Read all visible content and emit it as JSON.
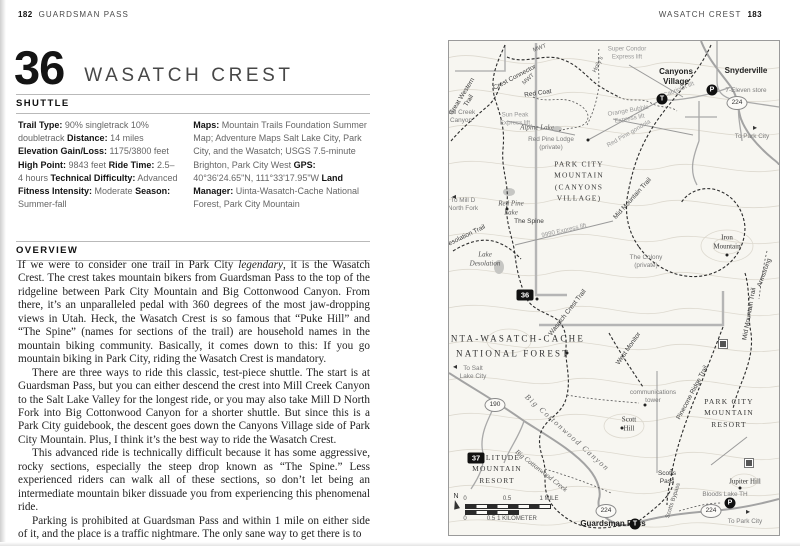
{
  "left_page": {
    "page_number": "182",
    "running_header": "GUARDSMAN PASS",
    "ride_number": "36",
    "ride_name": "WASATCH CREST",
    "shuttle_header": "SHUTTLE",
    "overview_header": "OVERVIEW",
    "stats_left": [
      {
        "label": "Trail Type:",
        "value": "90% singletrack 10% doubletrack"
      },
      {
        "label": "Distance:",
        "value": "14 miles"
      },
      {
        "label": "Elevation Gain/Loss:",
        "value": "1175/3800 feet"
      },
      {
        "label": "High Point:",
        "value": "9843 feet"
      },
      {
        "label": "Ride Time:",
        "value": "2.5–4 hours"
      },
      {
        "label": "Technical Difficulty:",
        "value": "Advanced"
      },
      {
        "label": "Fitness Intensity:",
        "value": "Moderate"
      },
      {
        "label": "Season:",
        "value": "Summer-fall"
      }
    ],
    "stats_right": [
      {
        "label": "Maps:",
        "value": "Mountain Trails Foundation Summer Map; Adventure Maps Salt Lake City, Park City, and the Wasatch; USGS 7.5-minute Brighton, Park City West"
      },
      {
        "label": "GPS:",
        "value": "40°36'24.65\"N, 111°33'17.95\"W"
      },
      {
        "label": "Land Manager:",
        "value": "Uinta-Wasatch-Cache National Forest, Park City Mountain"
      }
    ],
    "overview_paragraphs": [
      "If we were to consider one trail in Park City *legendary*, it is the Wasatch Crest. The crest takes mountain bikers from Guardsman Pass to the top of the ridgeline between Park City Mountain and Big Cottonwood Canyon. From there, it’s an unparalleled pedal with 360 degrees of the most jaw-dropping views in Utah. Heck, the Wasatch Crest is so famous that “Puke Hill” and “The Spine” (names for sections of the trail) are household names in the mountain biking community. Basically, it comes down to this: If you go mountain biking in Park City, riding the Wasatch Crest is mandatory.",
      "There are three ways to ride this classic, test-piece shuttle. The start is at Guardsman Pass, but you can either descend the crest into Mill Creek Canyon to the Salt Lake Valley for the longest ride, or you may also take Mill D North Fork into Big Cottonwood Canyon for a shorter shuttle. But since this is a Park City guidebook, the descent goes down the Canyons Village side of Park City Mountain. Plus, I think it’s the best way to ride the Wasatch Crest.",
      "This advanced ride is technically difficult because it has some aggressive, rocky sections, especially the steep drop known as “The Spine.” Less experienced riders can walk all of these sections, so don’t let being an intermediate mountain biker dissuade you from experiencing this phenomenal ride.",
      "Parking is prohibited at Guardsman Pass and within 1 mile on either side of it, and the place is a traffic nightmare. The only sane way to get there is to"
    ]
  },
  "right_page": {
    "running_header": "WASATCH CREST",
    "page_number": "183",
    "map": {
      "labels": [
        {
          "t": "MWT",
          "x": 91,
          "y": 8,
          "c": "tiny",
          "r": -20
        },
        {
          "t": "MWT",
          "x": 80,
          "y": 39,
          "c": "tiny",
          "r": -42
        },
        {
          "t": "Crest Connector",
          "x": 66,
          "y": 37,
          "c": "trail",
          "r": -28
        },
        {
          "t": "Great Western\nTrail",
          "x": 17,
          "y": 58,
          "c": "trail",
          "r": -58
        },
        {
          "t": "Red Coat",
          "x": 89,
          "y": 53,
          "c": "trail",
          "r": -8
        },
        {
          "t": "Holly's",
          "x": 150,
          "y": 24,
          "c": "tiny",
          "r": -64
        },
        {
          "t": "Sun Peak\nExpress lift",
          "x": 66,
          "y": 78,
          "c": "lift"
        },
        {
          "t": "Super Condor\nExpress lift",
          "x": 178,
          "y": 12,
          "c": "lift"
        },
        {
          "t": "Orange Bubble\nExpress lift",
          "x": 180,
          "y": 74,
          "c": "lift",
          "r": -10
        },
        {
          "t": "Red Pine gondola",
          "x": 180,
          "y": 93,
          "c": "lift",
          "r": -30
        },
        {
          "t": "Cabriolet lift",
          "x": 230,
          "y": 49,
          "c": "lift",
          "r": -22
        },
        {
          "t": "Canyons\nVillage",
          "x": 227,
          "y": 36,
          "c": "town"
        },
        {
          "t": "Snyderville",
          "x": 297,
          "y": 30,
          "c": "town"
        },
        {
          "t": "7-Eleven store",
          "x": 297,
          "y": 50,
          "c": "small"
        },
        {
          "t": "To Park City",
          "x": 303,
          "y": 96,
          "c": "small"
        },
        {
          "t": "Mill Creek\nCanyon",
          "x": 12,
          "y": 76,
          "c": "small"
        },
        {
          "t": "Alpine Lake",
          "x": 88,
          "y": 87,
          "c": "water"
        },
        {
          "t": "Red Pine Lodge\n(private)",
          "x": 102,
          "y": 103,
          "c": "small"
        },
        {
          "t": "PARK CITY\nMOUNTAIN\n(CANYONS\nVILLAGE)",
          "x": 130,
          "y": 140,
          "c": "place"
        },
        {
          "t": "Red Pine\nLake",
          "x": 62,
          "y": 167,
          "c": "water"
        },
        {
          "t": "The Spine",
          "x": 80,
          "y": 181,
          "c": "trail"
        },
        {
          "t": "9990 Express lift",
          "x": 115,
          "y": 190,
          "c": "lift",
          "r": -13
        },
        {
          "t": "Mid Mountain Trail",
          "x": 184,
          "y": 158,
          "c": "trail",
          "r": -48
        },
        {
          "t": "Iron\nMountain",
          "x": 278,
          "y": 202,
          "c": "peak"
        },
        {
          "t": "The Colony\n(private)",
          "x": 197,
          "y": 221,
          "c": "small"
        },
        {
          "t": "Armstrong",
          "x": 316,
          "y": 232,
          "c": "trail",
          "r": -70
        },
        {
          "t": "Desolation Trail",
          "x": 16,
          "y": 196,
          "c": "trail",
          "r": -26
        },
        {
          "t": "To Mill D\nNorth Fork",
          "x": 14,
          "y": 164,
          "c": "small"
        },
        {
          "t": "Lake\nDesolation",
          "x": 36,
          "y": 218,
          "c": "water"
        },
        {
          "t": "Wasatch Crest Trail",
          "x": 119,
          "y": 272,
          "c": "trail",
          "r": -52
        },
        {
          "t": "UINTA-WASATCH-CACHE",
          "x": 62,
          "y": 298,
          "c": "forest"
        },
        {
          "t": "NATIONAL FOREST",
          "x": 64,
          "y": 313,
          "c": "forest"
        },
        {
          "t": "To Salt\nLake City",
          "x": 24,
          "y": 332,
          "c": "small"
        },
        {
          "t": "Big Cottonwood Canyon",
          "x": 118,
          "y": 392,
          "c": "canyon",
          "r": 42
        },
        {
          "t": "Big Cottonwood Creek",
          "x": 92,
          "y": 430,
          "c": "water",
          "r": 38
        },
        {
          "t": "West Monitor",
          "x": 180,
          "y": 308,
          "c": "trail",
          "r": -55
        },
        {
          "t": "Mid Mountain Trail",
          "x": 301,
          "y": 273,
          "c": "trail",
          "r": -80
        },
        {
          "t": "communications\ntower",
          "x": 204,
          "y": 356,
          "c": "small"
        },
        {
          "t": "Scott\nHill",
          "x": 180,
          "y": 384,
          "c": "peak"
        },
        {
          "t": "Pinecone Ridge Trail",
          "x": 244,
          "y": 352,
          "c": "trail",
          "r": -62
        },
        {
          "t": "PARK CITY\nMOUNTAIN\nRESORT",
          "x": 280,
          "y": 372,
          "c": "place"
        },
        {
          "t": "Jupiter Hill",
          "x": 296,
          "y": 441,
          "c": "peak"
        },
        {
          "t": "Bloods Lake TH",
          "x": 276,
          "y": 454,
          "c": "small"
        },
        {
          "t": "Scotts\nPass",
          "x": 218,
          "y": 437,
          "c": "trail"
        },
        {
          "t": "Scotts Bypass",
          "x": 225,
          "y": 460,
          "c": "tiny",
          "r": -72
        },
        {
          "t": "SOLITUDE\nMOUNTAIN\nRESORT",
          "x": 48,
          "y": 428,
          "c": "place"
        },
        {
          "t": "Guardsman Pass",
          "x": 164,
          "y": 483,
          "c": "town"
        },
        {
          "t": "To Park City",
          "x": 296,
          "y": 481,
          "c": "small"
        }
      ],
      "badges": [
        {
          "t": "36",
          "x": 76,
          "y": 254
        },
        {
          "t": "37",
          "x": 27,
          "y": 417
        }
      ],
      "shields": [
        {
          "t": "224",
          "x": 288,
          "y": 62
        },
        {
          "t": "190",
          "x": 46,
          "y": 364
        },
        {
          "t": "224",
          "x": 157,
          "y": 470
        },
        {
          "t": "224",
          "x": 262,
          "y": 470
        }
      ],
      "stations": [
        {
          "t": "T",
          "x": 213,
          "y": 58
        },
        {
          "t": "P",
          "x": 263,
          "y": 49
        },
        {
          "t": "T",
          "x": 186,
          "y": 483
        },
        {
          "t": "P",
          "x": 281,
          "y": 462
        }
      ],
      "dots": [
        {
          "x": 139,
          "y": 99
        },
        {
          "x": 278,
          "y": 214
        },
        {
          "x": 173,
          "y": 387
        },
        {
          "x": 291,
          "y": 447
        },
        {
          "x": 196,
          "y": 364
        },
        {
          "x": 88,
          "y": 258
        },
        {
          "x": 118,
          "y": 312
        },
        {
          "x": 58,
          "y": 168
        }
      ],
      "huts": [
        {
          "x": 274,
          "y": 303
        },
        {
          "x": 300,
          "y": 422
        }
      ],
      "arrows": [
        {
          "t": "▸",
          "x": 306,
          "y": 87
        },
        {
          "t": "▸",
          "x": 299,
          "y": 471
        },
        {
          "t": "◂",
          "x": 5,
          "y": 156
        },
        {
          "t": "◂",
          "x": 6,
          "y": 326
        }
      ],
      "scale": {
        "north": "N",
        "mile_labels": [
          "0",
          "0.5",
          "1 MILE"
        ],
        "km_labels": [
          "0",
          "0.5",
          "1 KILOMETER"
        ]
      }
    }
  }
}
